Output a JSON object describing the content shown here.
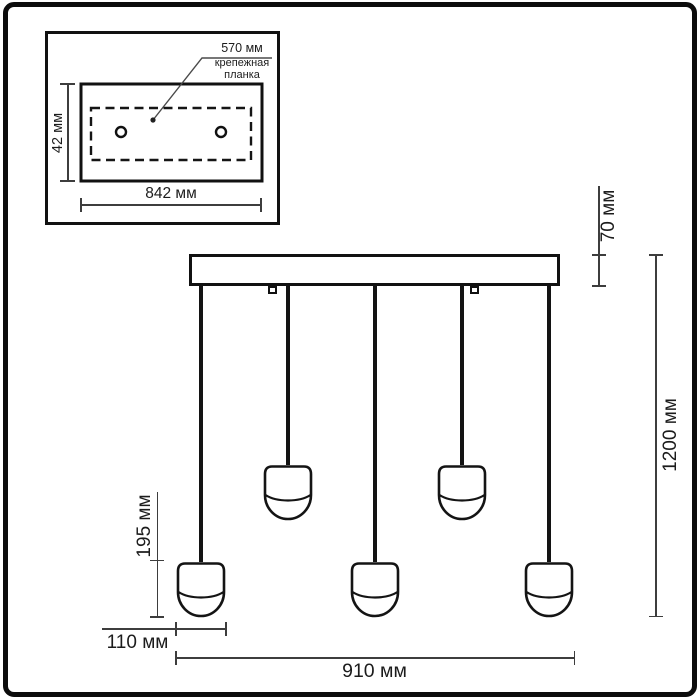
{
  "inset": {
    "bracket_width_label": "570 мм",
    "bracket_name_line1": "крепежная",
    "bracket_name_line2": "планка",
    "plate_height_label": "42 мм",
    "plate_width_label": "842 мм"
  },
  "main": {
    "canopy_height_label": "70 мм",
    "total_height_label": "1200 мм",
    "shade_height_label": "195 мм",
    "shade_width_label": "110 мм",
    "total_width_label": "910 мм",
    "pendant_count": 5
  },
  "colors": {
    "drawing_line": "#141414",
    "dimension_line": "#3d3d3d",
    "text": "#1a1a1a",
    "background": "#ffffff"
  }
}
